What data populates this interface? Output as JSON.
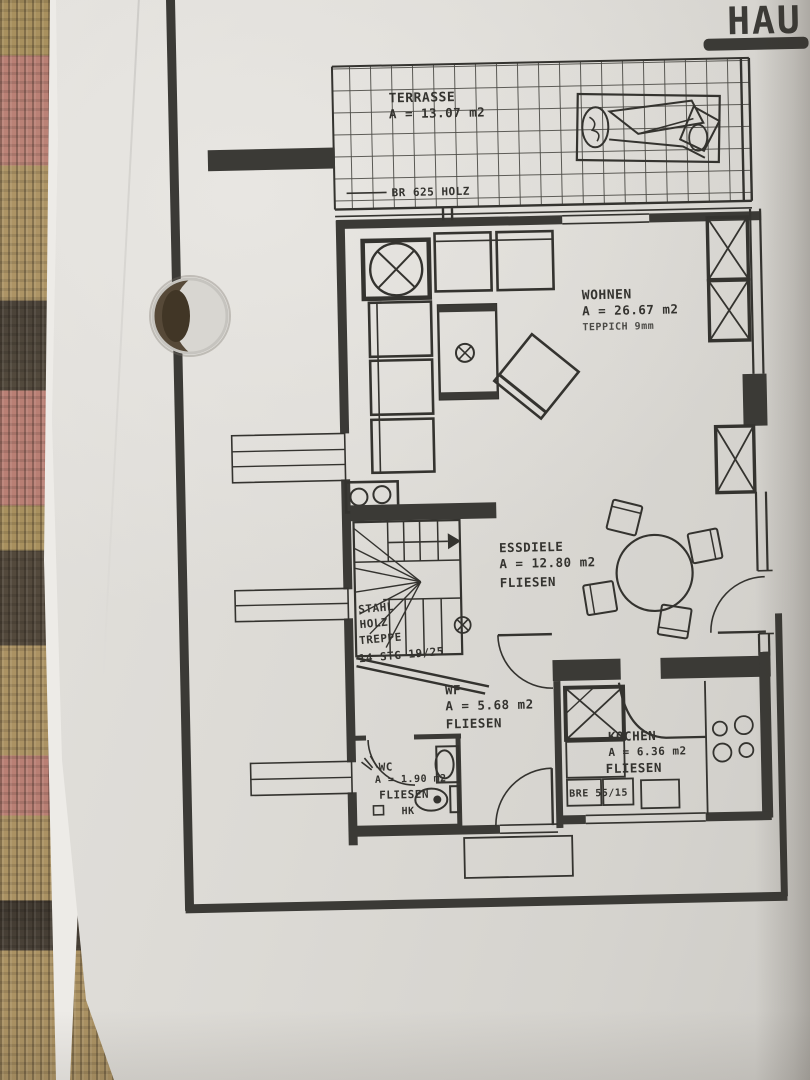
{
  "title": {
    "fragment": "HAU"
  },
  "rooms": {
    "terrasse": {
      "name": "TERRASSE",
      "area": "A = 13.07 m2"
    },
    "wohnen": {
      "name": "WOHNEN",
      "area": "A = 26.67 m2",
      "floor": "TEPPICH 9mm"
    },
    "essdiele": {
      "name": "ESSDIELE",
      "area": "A = 12.80 m2",
      "floor": "FLIESEN"
    },
    "wf": {
      "name": "WF",
      "area": "A = 5.68 m2",
      "floor": "FLIESEN"
    },
    "kochen": {
      "name": "KOCHEN",
      "area": "A = 6.36 m2",
      "floor": "FLIESEN"
    },
    "wc": {
      "name": "WC",
      "area": "A = 1.90 m2",
      "floor": "FLIESEN",
      "radiator": "HK"
    }
  },
  "annotations": {
    "terrace_rail": "BR 625 HOLZ",
    "stairs_line1": "STAHL",
    "stairs_line2": "HOLZ",
    "stairs_line3": "TREPPE",
    "stairs_line4": "14 STG 19/25",
    "kitchen_counter": "BRE 55/15"
  },
  "colors": {
    "ink": "#34332f",
    "paper": "#dcdad5",
    "fabric_tan": "#ab9263",
    "fabric_rose": "#b97f74",
    "fabric_dark": "#4a4238"
  }
}
